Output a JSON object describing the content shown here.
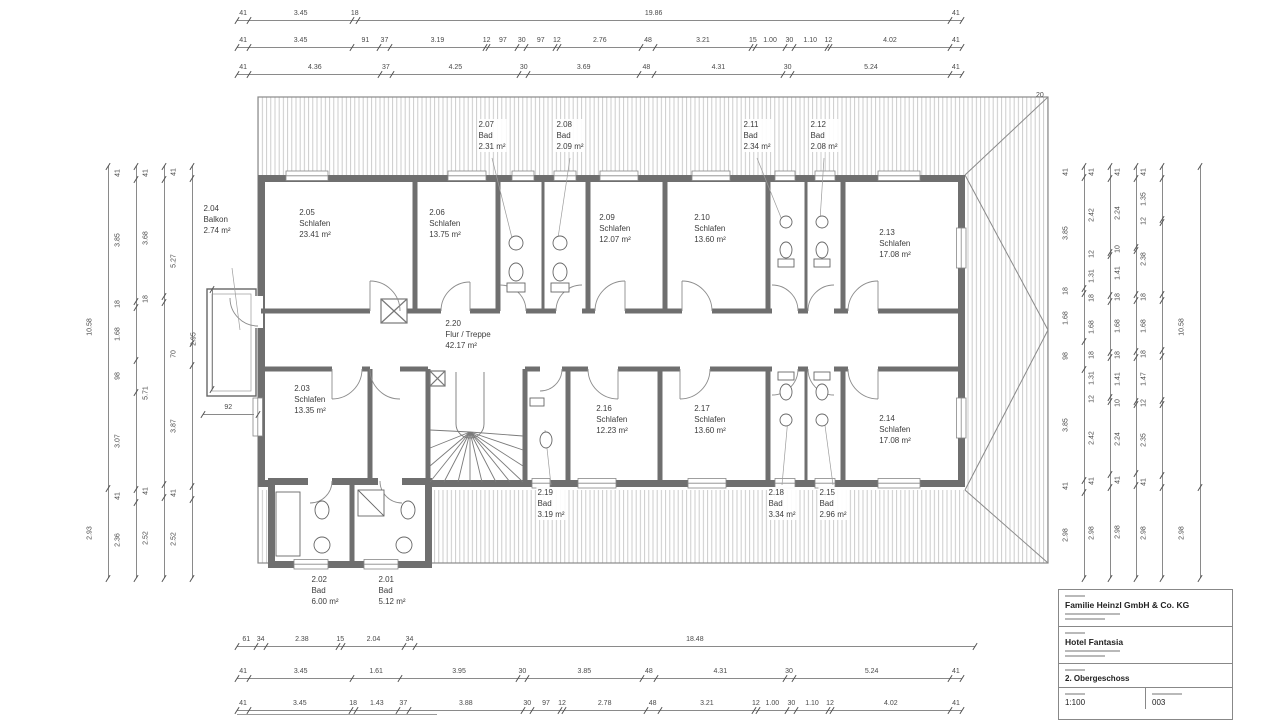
{
  "drawing": {
    "rooms": {
      "r201": {
        "number": "2.01",
        "name": "Bad",
        "area": "5.12 m²"
      },
      "r202": {
        "number": "2.02",
        "name": "Bad",
        "area": "6.00 m²"
      },
      "r203": {
        "number": "2.03",
        "name": "Schlafen",
        "area": "13.35 m²"
      },
      "r204": {
        "number": "2.04",
        "name": "Balkon",
        "area": "2.74 m²"
      },
      "r205": {
        "number": "2.05",
        "name": "Schlafen",
        "area": "23.41 m²"
      },
      "r206": {
        "number": "2.06",
        "name": "Schlafen",
        "area": "13.75 m²"
      },
      "r207": {
        "number": "2.07",
        "name": "Bad",
        "area": "2.31 m²"
      },
      "r208": {
        "number": "2.08",
        "name": "Bad",
        "area": "2.09 m²"
      },
      "r209": {
        "number": "2.09",
        "name": "Schlafen",
        "area": "12.07 m²"
      },
      "r210": {
        "number": "2.10",
        "name": "Schlafen",
        "area": "13.60 m²"
      },
      "r211": {
        "number": "2.11",
        "name": "Bad",
        "area": "2.34 m²"
      },
      "r212": {
        "number": "2.12",
        "name": "Bad",
        "area": "2.08 m²"
      },
      "r213": {
        "number": "2.13",
        "name": "Schlafen",
        "area": "17.08 m²"
      },
      "r214": {
        "number": "2.14",
        "name": "Schlafen",
        "area": "17.08 m²"
      },
      "r215": {
        "number": "2.15",
        "name": "Bad",
        "area": "2.96 m²"
      },
      "r216": {
        "number": "2.16",
        "name": "Schlafen",
        "area": "12.23 m²"
      },
      "r217": {
        "number": "2.17",
        "name": "Schlafen",
        "area": "13.60 m²"
      },
      "r218": {
        "number": "2.18",
        "name": "Bad",
        "area": "3.34 m²"
      },
      "r219": {
        "number": "2.19",
        "name": "Bad",
        "area": "3.19 m²"
      },
      "r220": {
        "number": "2.20",
        "name": "Flur / Treppe",
        "area": "42.17 m²"
      }
    },
    "dims": {
      "top1": [
        "41",
        "3.45",
        "18",
        "19.86",
        "41"
      ],
      "top2": [
        "41",
        "3.45",
        "91",
        "37",
        "3.19",
        "12",
        "97",
        "30",
        "97",
        "12",
        "2.76",
        "48",
        "3.21",
        "15",
        "1.00",
        "30",
        "1.10",
        "12",
        "4.02",
        "41"
      ],
      "top3": [
        "41",
        "4.36",
        "37",
        "4.25",
        "30",
        "3.69",
        "48",
        "4.31",
        "30",
        "5.24",
        "41"
      ],
      "bottom1": [
        "61",
        "34",
        "2.38",
        "15",
        "2.04",
        "34",
        "18.48"
      ],
      "bottom2": [
        "41",
        "3.45",
        "1.61",
        "3.95",
        "30",
        "3.85",
        "48",
        "4.31",
        "30",
        "5.24",
        "41"
      ],
      "bottom3": [
        "41",
        "3.45",
        "18",
        "1.43",
        "37",
        "3.88",
        "30",
        "97",
        "12",
        "2.78",
        "48",
        "3.21",
        "12",
        "1.00",
        "30",
        "1.10",
        "12",
        "4.02",
        "41"
      ],
      "left1": [
        "10.58",
        "2.93"
      ],
      "left2": [
        "41",
        "3.85",
        "18",
        "1.68",
        "98",
        "3.07",
        "41",
        "2.36"
      ],
      "left3": [
        "41",
        "3.68",
        "18",
        "5.71",
        "41",
        "2.52"
      ],
      "left4": [
        "41",
        "5.27",
        "70",
        "3.87",
        "41",
        "2.52"
      ],
      "right1": [
        "41",
        "3.85",
        "18",
        "1.68",
        "98",
        "3.85",
        "41",
        "2.98"
      ],
      "right2": [
        "41",
        "2.42",
        "12",
        "1.31",
        "18",
        "1.68",
        "18",
        "1.31",
        "12",
        "2.42",
        "41",
        "2.98"
      ],
      "right3": [
        "41",
        "2.24",
        "10",
        "1.41",
        "18",
        "1.68",
        "18",
        "1.41",
        "10",
        "2.24",
        "41",
        "2.98"
      ],
      "right4": [
        "41",
        "1.35",
        "12",
        "2.38",
        "18",
        "1.68",
        "18",
        "1.47",
        "12",
        "2.35",
        "41",
        "2.98"
      ],
      "right5": [
        "10.58",
        "2.98"
      ],
      "balcony_len": [
        "2.95"
      ],
      "balcony_depth": [
        "92"
      ],
      "corner": "20"
    },
    "titleblock": {
      "company": "Familie Heinzl GmbH & Co. KG",
      "project": "Hotel Fantasia",
      "floor": "2. Obergeschoss",
      "scale": "1:100",
      "sheet": "003"
    }
  }
}
